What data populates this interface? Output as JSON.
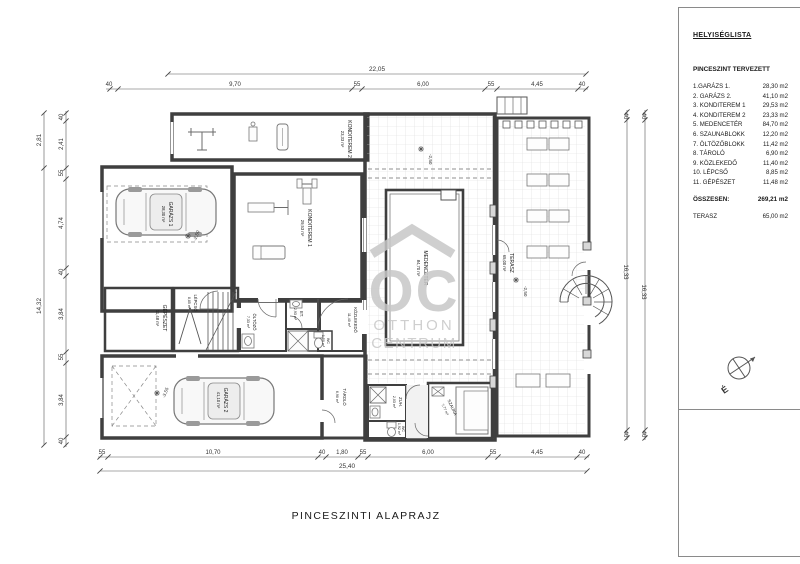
{
  "legend": {
    "heading": "HELYISÉGLISTA",
    "subheading": "PINCESZINT TERVEZETT",
    "rooms": [
      {
        "name": "1.GARÁZS 1.",
        "area": "28,30 m2"
      },
      {
        "name": "2. GARÁZS 2.",
        "area": "41,10 m2"
      },
      {
        "name": "3. KONDITEREM 1",
        "area": "29,53 m2"
      },
      {
        "name": "4. KONDITEREM 2",
        "area": "23,33 m2"
      },
      {
        "name": "5. MEDENCETÉR",
        "area": "84,70 m2"
      },
      {
        "name": "6. SZAUNABLOKK",
        "area": "12,20 m2"
      },
      {
        "name": "7. ÖLTÖZŐBLOKK",
        "area": "11,42 m2"
      },
      {
        "name": "8. TÁROLÓ",
        "area": "6,90 m2"
      },
      {
        "name": "9. KÖZLEKEDŐ",
        "area": "11,40 m2"
      },
      {
        "name": "10. LÉPCSŐ",
        "area": "8,85 m2"
      },
      {
        "name": "11. GÉPÉSZET",
        "area": "11,48 m2"
      }
    ],
    "total_label": "ÖSSZESEN:",
    "total_area": "269,21 m2",
    "terasz_label": "TERASZ",
    "terasz_area": "65,00 m2"
  },
  "plan": {
    "sheet_title": "PINCESZINTI ALAPRAJZ",
    "compass_label": "É",
    "watermark": {
      "logo": "OC",
      "line1": "OTTHON",
      "line2": "CENTRUM"
    },
    "rooms": {
      "konditerem2": {
        "name": "KONDITEREM 2",
        "area": "23,33 m²"
      },
      "konditerem1": {
        "name": "KONDITEREM 1",
        "area": "29,53 m²"
      },
      "medenceter": {
        "name": "MEDENCETÉR",
        "area": "84,70 m²"
      },
      "terasz": {
        "name": "TERASZ",
        "area": "65,00 m²"
      },
      "garazs1": {
        "name": "GARÁZS 1",
        "area": "28,30 m²"
      },
      "garazs2": {
        "name": "GARÁZS 2",
        "area": "41,10 m²"
      },
      "gepeszet": {
        "name": "GÉPÉSZET",
        "area": "11,48 m²"
      },
      "lepcso": {
        "name": "LÉPCSŐ",
        "area": "8,85 m²"
      },
      "oltozo": {
        "name": "ÖLTÖZŐ",
        "area": "7,33 m²"
      },
      "et": {
        "name": "ET.",
        "area": "2,93 m²"
      },
      "wc1": {
        "name": "WC",
        "area": "1,50 m²"
      },
      "kozlekedo": {
        "name": "KÖZLEKEDŐ",
        "area": "11,40 m²"
      },
      "tarolo": {
        "name": "TÁROLÓ",
        "area": "6,90 m²"
      },
      "zuh": {
        "name": "ZUH.",
        "area": "2,03 m²"
      },
      "wc2": {
        "name": "WC",
        "area": "1,92 m²"
      },
      "szauna": {
        "name": "SZAUNA",
        "area": "7,77 m²"
      }
    },
    "levels": {
      "medenceter": "-2,50",
      "terasz": "-2,50",
      "garazs1": "-2,50",
      "garazs2": "-3,55"
    },
    "dims": {
      "top_total": "22,05",
      "top_segments": [
        "40",
        "9,70",
        "55",
        "6,00",
        "55",
        "4,45",
        "40"
      ],
      "bottom_total": "25,40",
      "bottom_segments": [
        "55",
        "10,70",
        "40",
        "1,80",
        "55",
        "6,00",
        "55",
        "4,45",
        "40"
      ],
      "left_total_top": "2,81",
      "left_total": "14,32",
      "left_segments": [
        "40",
        "2,41",
        "55",
        "4,74",
        "40",
        "3,84",
        "55",
        "3,84",
        "40"
      ],
      "right_segments": [
        "40",
        "16,33",
        "40"
      ]
    }
  }
}
